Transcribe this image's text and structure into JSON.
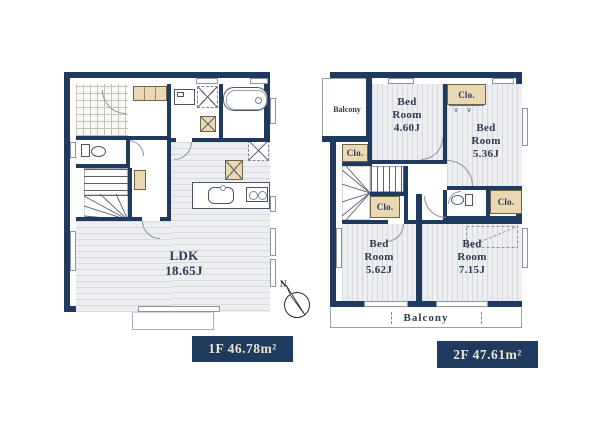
{
  "colors": {
    "wall_navy": "#1e3a5f",
    "closet_beige": "#e9d8b2",
    "room_fill": "#eceef1",
    "label_bg": "#1e3a5f",
    "label_text": "#ece4cf"
  },
  "floor1": {
    "area_label": "1F 46.78m²",
    "ldk": {
      "name": "LDK",
      "size": "18.65J"
    }
  },
  "floor2": {
    "area_label": "2F 47.61m²",
    "balcony_top": "Balcony",
    "balcony_bottom": "Balcony",
    "closets": {
      "top": "Clo.",
      "left": "Clo.",
      "mid": "Clo.",
      "right": "Clo."
    },
    "bedroom_tl": {
      "name": "Bed Room",
      "size": "4.60J"
    },
    "bedroom_tr": {
      "name": "Bed Room",
      "size": "5.36J"
    },
    "bedroom_bl": {
      "name": "Bed Room",
      "size": "5.62J"
    },
    "bedroom_br": {
      "name": "Bed Room",
      "size": "7.15J"
    }
  },
  "compass": {
    "north": "N"
  }
}
